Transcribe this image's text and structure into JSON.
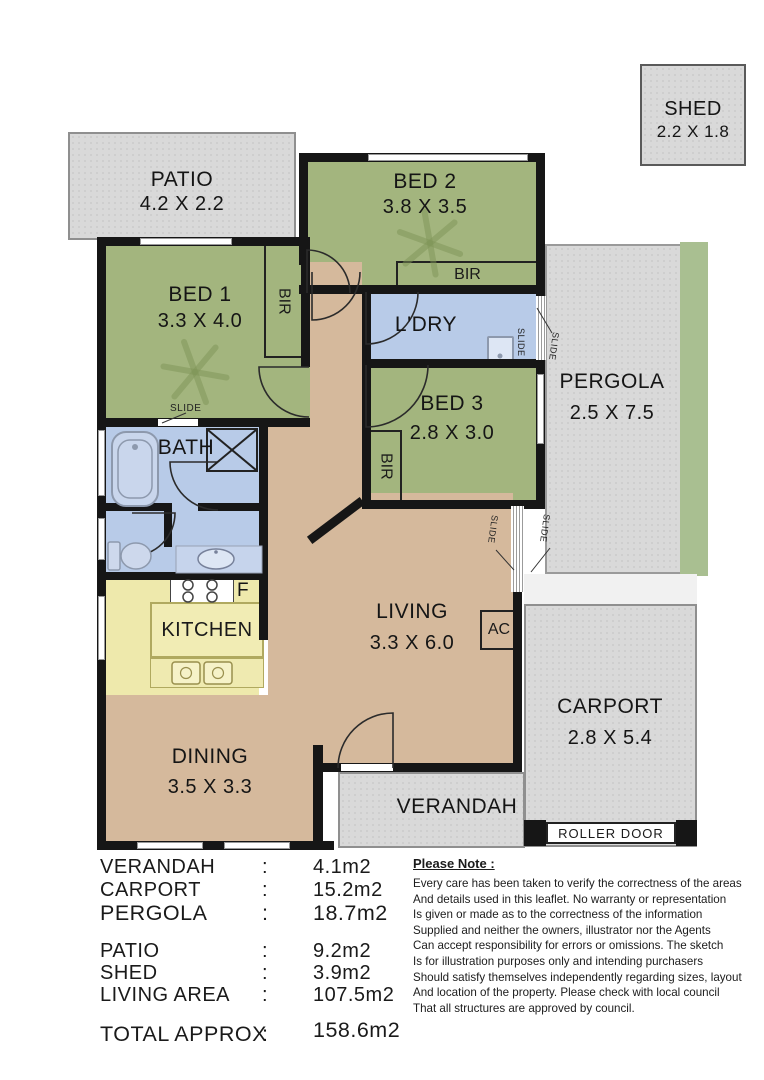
{
  "rooms": {
    "patio": {
      "name": "PATIO",
      "dims": "4.2 X 2.2"
    },
    "shed": {
      "name": "SHED",
      "dims": "2.2 X 1.8"
    },
    "bed2": {
      "name": "BED 2",
      "dims": "3.8 X 3.5"
    },
    "bed1": {
      "name": "BED 1",
      "dims": "3.3 X 4.0"
    },
    "laundry": {
      "name": "L'DRY"
    },
    "bed3": {
      "name": "BED 3",
      "dims": "2.8 X 3.0"
    },
    "pergola": {
      "name": "PERGOLA",
      "dims": "2.5 X 7.5"
    },
    "bath": {
      "name": "BATH"
    },
    "kitchen": {
      "name": "KITCHEN"
    },
    "living": {
      "name": "LIVING",
      "dims": "3.3 X 6.0"
    },
    "dining": {
      "name": "DINING",
      "dims": "3.5 X 3.3"
    },
    "verandah": {
      "name": "VERANDAH"
    },
    "carport": {
      "name": "CARPORT",
      "dims": "2.8 X 5.4"
    }
  },
  "labels": {
    "bir": "BIR",
    "slide": "SLIDE",
    "fridge": "F",
    "ac": "AC",
    "roller_door": "ROLLER DOOR"
  },
  "summary": {
    "rows": [
      {
        "label": "VERANDAH",
        "sep": ":",
        "value": "4.1m2"
      },
      {
        "label": "CARPORT",
        "sep": ":",
        "value": "15.2m2"
      },
      {
        "label": "PERGOLA",
        "sep": ":",
        "value": "18.7m2"
      },
      {
        "label": "PATIO",
        "sep": ":",
        "value": "9.2m2"
      },
      {
        "label": "SHED",
        "sep": ":",
        "value": "3.9m2"
      },
      {
        "label": "LIVING  AREA",
        "sep": ":",
        "value": "107.5m2"
      }
    ],
    "total": {
      "label": "TOTAL APPROX",
      "sep": ":",
      "value": "158.6m2"
    }
  },
  "note": {
    "title": "Please Note :",
    "lines": [
      "Every care has been taken to verify the correctness of the areas",
      "And details used in this leaflet. No warranty or representation",
      "Is given or made as to the correctness of the information",
      "Supplied and neither the owners, illustrator nor the Agents",
      "Can accept responsibility for errors or omissions. The sketch",
      "Is for illustration purposes only and intending purchasers",
      "Should satisfy themselves independently regarding sizes, layout",
      "And location of the property. Please check with local council",
      "That all structures are approved by council."
    ]
  },
  "colors": {
    "bedroom_green": "#a3b57e",
    "wet_area_blue": "#b8cbe8",
    "living_tan": "#d5b99c",
    "kitchen_yellow": "#eee9ac",
    "structure_grey": "#d9d9d9",
    "pergola_green_strip": "#a9bf91",
    "wall_black": "#161616"
  }
}
